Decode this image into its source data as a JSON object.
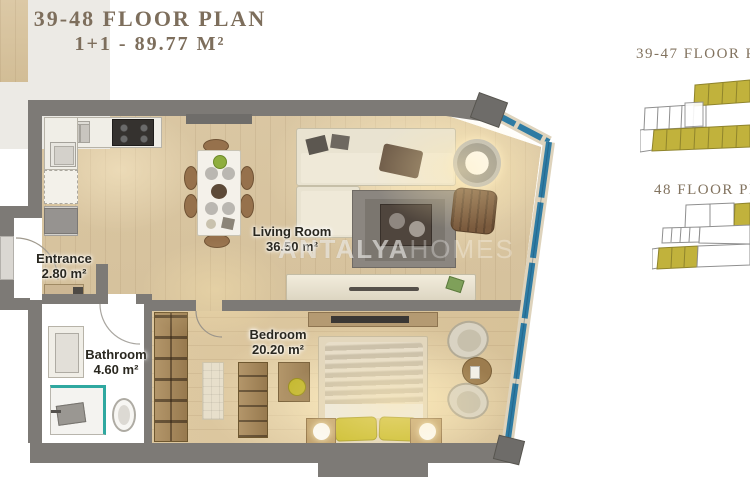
{
  "title": {
    "line1": "39-48 FLOOR PLAN",
    "line2": "1+1 - 89.77 M²"
  },
  "key_plans": {
    "plan1_label": "39-47 FLOOR P",
    "plan2_label": "48 FLOOR PL"
  },
  "rooms": {
    "living": {
      "name": "Living Room",
      "area": "36.50 m²"
    },
    "bedroom": {
      "name": "Bedroom",
      "area": "20.20 m²"
    },
    "bathroom": {
      "name": "Bathroom",
      "area": "4.60 m²"
    },
    "entrance": {
      "name": "Entrance",
      "area": "2.80 m²"
    }
  },
  "watermark": {
    "brand_bold": "ANTALYA",
    "brand_light": "HOMES"
  },
  "colors": {
    "title_text": "#7d6e5c",
    "wall": "#7d7a76",
    "window_glass": "#2e7ba3",
    "keyplan_highlight": "#c1b23c",
    "fixture_teal": "#2fa8a0",
    "floor_wood": "#d9c6a1"
  }
}
